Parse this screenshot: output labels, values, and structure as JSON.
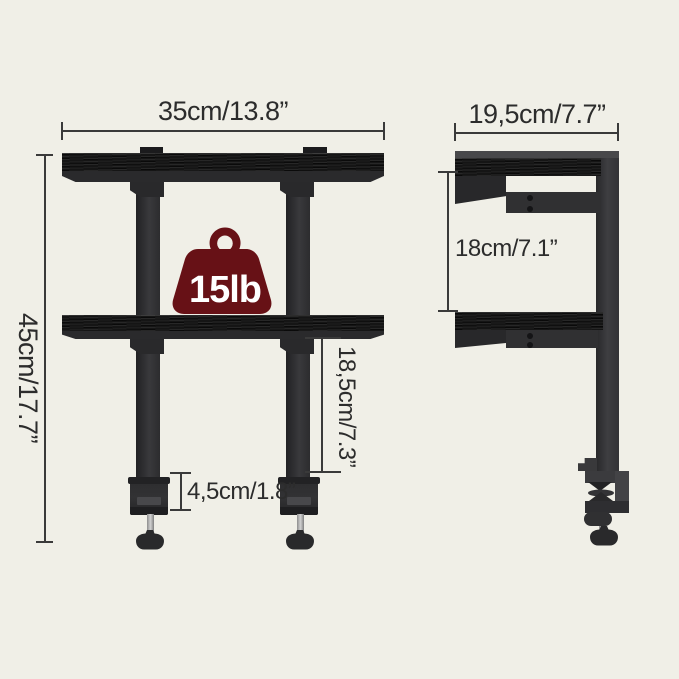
{
  "figure": {
    "weight_capacity": "15lb",
    "front_view": {
      "width": "35cm/13.8”",
      "height": "45cm/17.7”",
      "shelf_to_clamp": "18,5cm/7.3”",
      "clamp_opening": "4,5cm/1.8”"
    },
    "side_view": {
      "depth": "19,5cm/7.7”",
      "tier_spacing": "18cm/7.1”"
    },
    "colors": {
      "background": "#f0efe7",
      "shelf_wood": "#151515",
      "metal_frame": "#2e2e30",
      "dimension_lines": "#3a3a3a",
      "label_text": "#2c2c2c",
      "weight_badge": "#671116",
      "weight_badge_text": "#ffffff"
    }
  }
}
